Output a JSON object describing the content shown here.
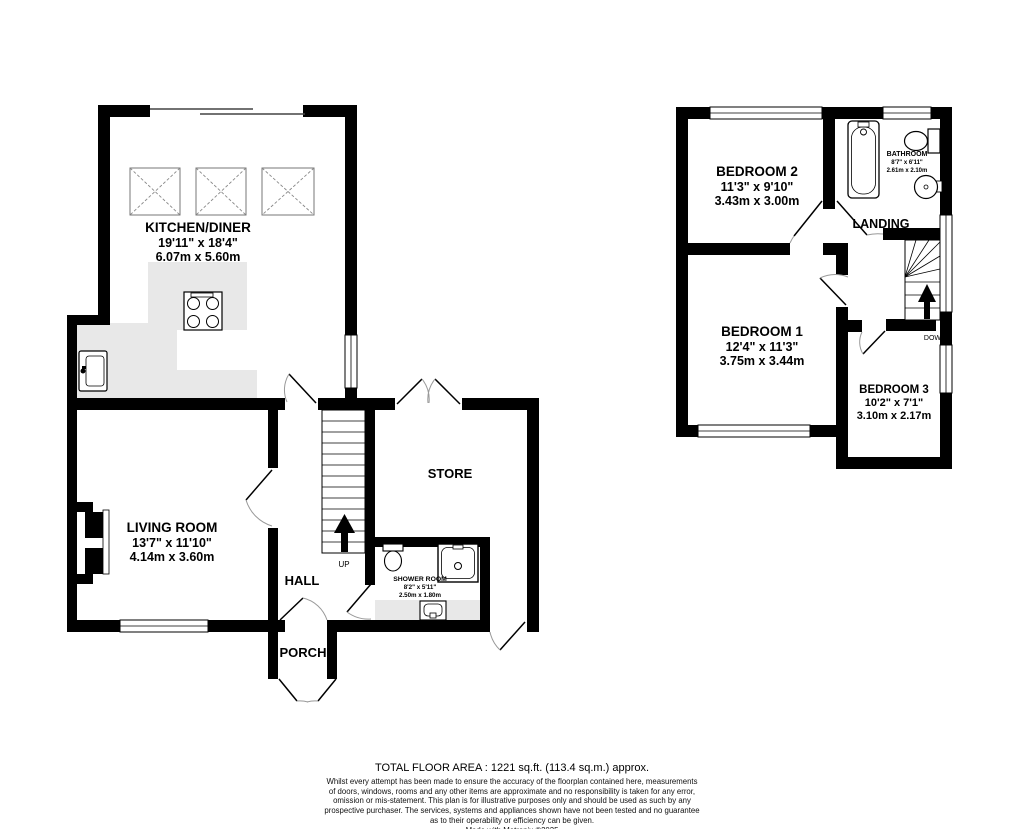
{
  "ground_floor": {
    "kitchen": {
      "name": "KITCHEN/DINER",
      "imperial": "19'11\" x 18'4\"",
      "metric": "6.07m x 5.60m"
    },
    "living_room": {
      "name": "LIVING ROOM",
      "imperial": "13'7\" x 11'10\"",
      "metric": "4.14m x 3.60m"
    },
    "hall": {
      "name": "HALL"
    },
    "porch": {
      "name": "PORCH"
    },
    "store": {
      "name": "STORE"
    },
    "shower_room": {
      "name": "SHOWER ROOM",
      "imperial": "8'2\" x 5'11\"",
      "metric": "2.50m x 1.80m"
    },
    "stairs": {
      "label": "UP"
    }
  },
  "first_floor": {
    "bedroom_2": {
      "name": "BEDROOM 2",
      "imperial": "11'3\" x 9'10\"",
      "metric": "3.43m x 3.00m"
    },
    "bathroom": {
      "name": "BATHROOM",
      "imperial": "8'7\" x 6'11\"",
      "metric": "2.61m x 2.10m"
    },
    "landing": {
      "name": "LANDING"
    },
    "bedroom_1": {
      "name": "BEDROOM 1",
      "imperial": "12'4\" x 11'3\"",
      "metric": "3.75m x 3.44m"
    },
    "bedroom_3": {
      "name": "BEDROOM 3",
      "imperial": "10'2\" x 7'1\"",
      "metric": "3.10m x 2.17m"
    },
    "stairs": {
      "label": "DOWN"
    }
  },
  "footer": {
    "total_area": "TOTAL FLOOR AREA : 1221 sq.ft. (113.4 sq.m.) approx.",
    "disclaimer_lines": [
      "Whilst every attempt has been made to ensure the accuracy of the floorplan contained here, measurements",
      "of doors, windows, rooms and any other items are approximate and no responsibility is taken for any error,",
      "omission or mis-statement. This plan is for illustrative purposes only and should be used as such by any",
      "prospective purchaser. The services, systems and appliances shown have not been tested and no guarantee",
      "as to their operability or efficiency can be given."
    ],
    "credit": "Made with Metropix ©2025"
  },
  "colors": {
    "wall": "#000000",
    "counter": "#e8e8e8",
    "background": "#ffffff"
  }
}
